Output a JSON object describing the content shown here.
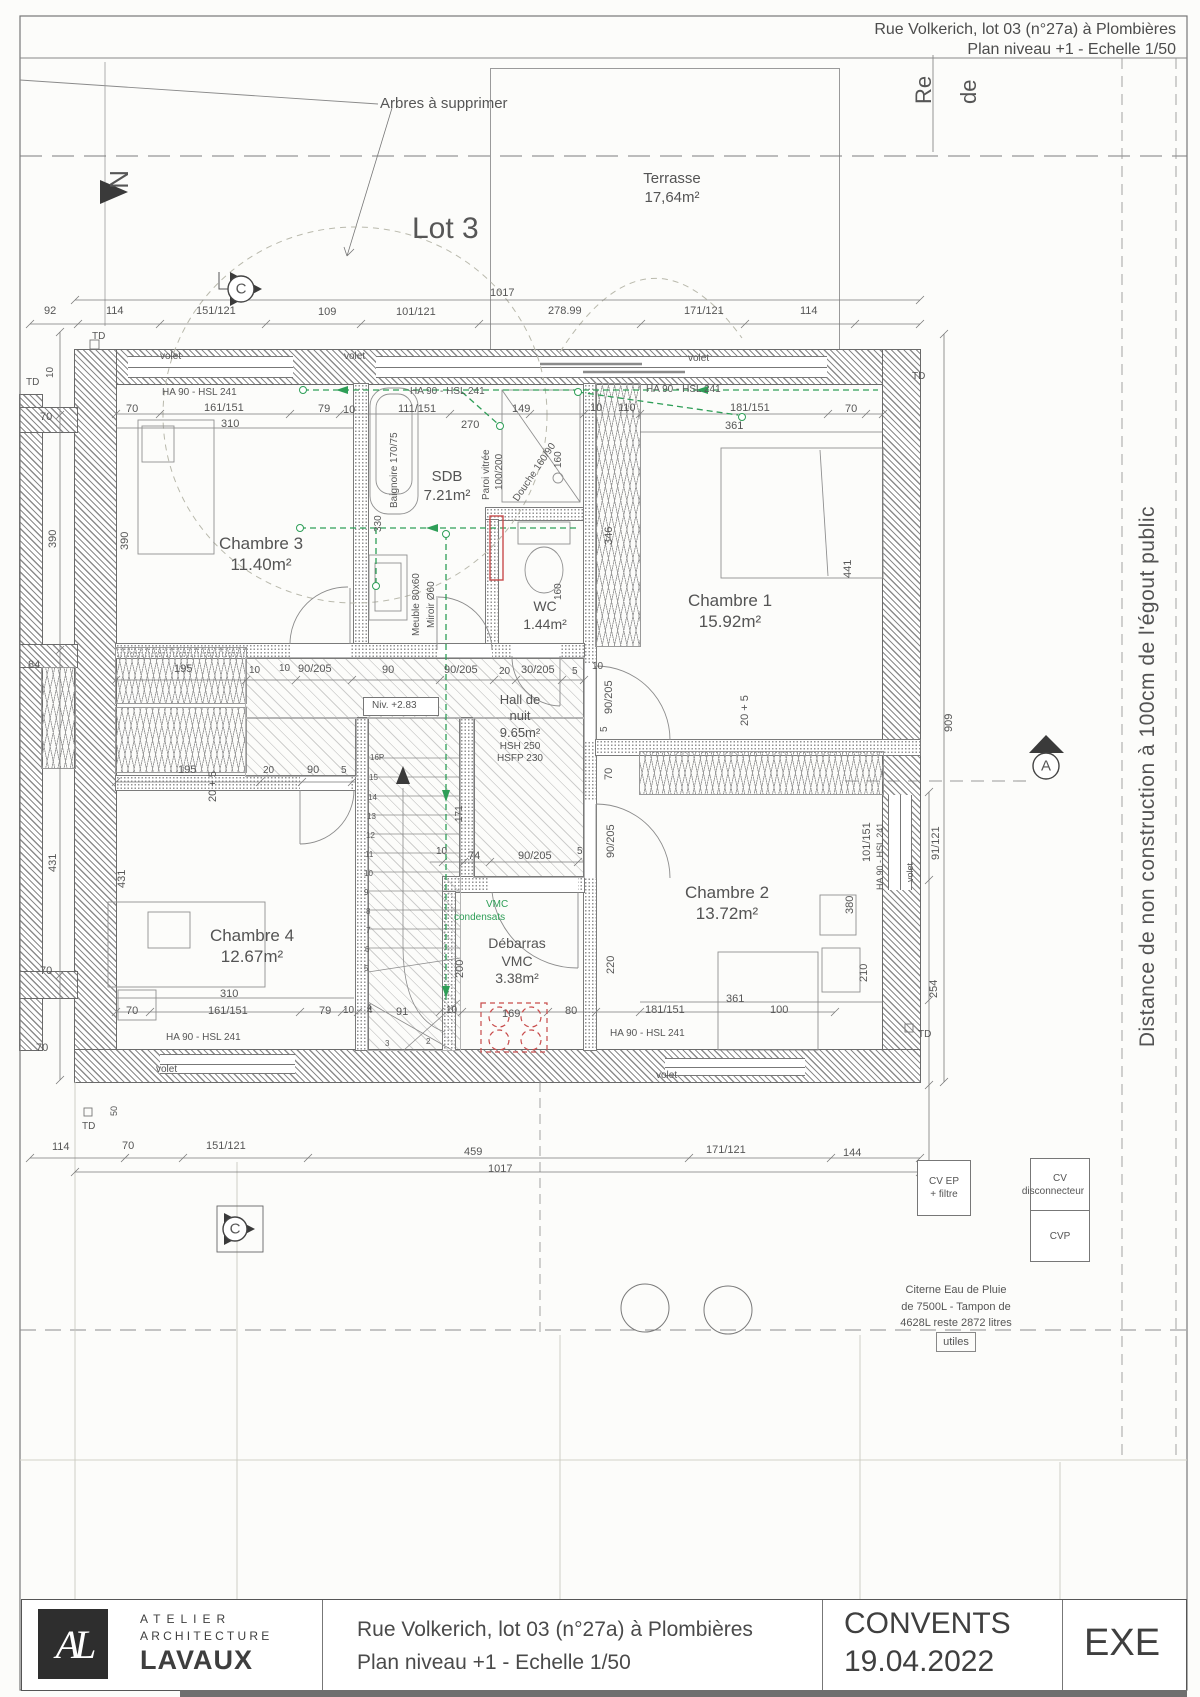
{
  "header": {
    "line1": "Rue Volkerich, lot 03 (n°27a) à Plombières",
    "line2": "Plan niveau +1 - Echelle 1/50"
  },
  "easement_note": "Distance de non construction à 100cm de l'égout public",
  "utilities": {
    "cv_ep_l1": "CV EP",
    "cv_ep_l2": "+ filtre",
    "cv_disc_l1": "CV",
    "cv_disc_l2": "disconnecteur",
    "cvp": "CVP",
    "cistern_l1": "Citerne Eau de Pluie",
    "cistern_l2": "de 7500L - Tampon de",
    "cistern_l3": "4628L reste 2872 litres",
    "cistern_l4": "utiles"
  },
  "title_block": {
    "logo": "AL",
    "company_l1": "ATELIER",
    "company_l2": "ARCHITECTURE",
    "company_l3": "LAVAUX",
    "project_l1": "Rue Volkerich, lot 03 (n°27a) à Plombières",
    "project_l2": "Plan niveau +1 - Echelle 1/50",
    "client": "CONVENTS",
    "date": "19.04.2022",
    "status": "EXE"
  },
  "plan": {
    "rooms": [
      {
        "id": "terrasse",
        "x": 672,
        "y": 170,
        "fs": 15,
        "lines": [
          "Terrasse",
          "17,64m²"
        ],
        "subs": []
      },
      {
        "id": "chambre-3",
        "x": 261,
        "y": 533,
        "fs": 17,
        "lines": [
          "Chambre 3",
          "11.40m²"
        ],
        "subs": []
      },
      {
        "id": "sdb",
        "x": 447,
        "y": 468,
        "fs": 15,
        "lines": [
          "SDB",
          "7.21m²"
        ],
        "subs": []
      },
      {
        "id": "wc",
        "x": 545,
        "y": 598,
        "fs": 14,
        "lines": [
          "WC",
          "1.44m²"
        ],
        "subs": []
      },
      {
        "id": "chambre-1",
        "x": 730,
        "y": 590,
        "fs": 17,
        "lines": [
          "Chambre 1",
          "15.92m²"
        ],
        "subs": []
      },
      {
        "id": "hall-de-nuit",
        "x": 520,
        "y": 692,
        "fs": 13,
        "lines": [
          "Hall de",
          "nuit",
          "9.65m²"
        ],
        "subs": [
          "HSH 250",
          "HSFP 230"
        ]
      },
      {
        "id": "chambre-4",
        "x": 252,
        "y": 925,
        "fs": 17,
        "lines": [
          "Chambre 4",
          "12.67m²"
        ],
        "subs": []
      },
      {
        "id": "debarras-vmc",
        "x": 517,
        "y": 935,
        "fs": 14,
        "lines": [
          "Débarras",
          "VMC",
          "3.38m²"
        ],
        "subs": []
      },
      {
        "id": "chambre-2",
        "x": 727,
        "y": 882,
        "fs": 17,
        "lines": [
          "Chambre 2",
          "13.72m²"
        ],
        "subs": []
      }
    ],
    "annotations": [
      {
        "t": "Arbres à supprimer",
        "x": 380,
        "y": 96,
        "s": 15,
        "n": "trees-note"
      },
      {
        "t": "Lot 3",
        "x": 412,
        "y": 214,
        "s": 30,
        "n": "lot-label"
      },
      {
        "t": "N",
        "x": 132,
        "y": 170,
        "r": 90,
        "s": 26,
        "n": "north-letter"
      },
      {
        "t": "Re",
        "x": 913,
        "y": 104,
        "r": -90,
        "s": 22,
        "n": "edge-label"
      },
      {
        "t": "de",
        "x": 958,
        "y": 104,
        "r": -90,
        "s": 22,
        "n": "edge-label"
      },
      {
        "t": "92",
        "x": 44,
        "y": 306
      },
      {
        "t": "114",
        "x": 106,
        "y": 306
      },
      {
        "t": "151/121",
        "x": 196,
        "y": 306
      },
      {
        "t": "109",
        "x": 318,
        "y": 307
      },
      {
        "t": "101/121",
        "x": 396,
        "y": 307
      },
      {
        "t": "278.99",
        "x": 548,
        "y": 306
      },
      {
        "t": "171/121",
        "x": 684,
        "y": 306
      },
      {
        "t": "114",
        "x": 800,
        "y": 306
      },
      {
        "t": "1017",
        "x": 490,
        "y": 288
      },
      {
        "t": "TD",
        "x": 92,
        "y": 332,
        "s": 10
      },
      {
        "t": "TD",
        "x": 26,
        "y": 378,
        "s": 10
      },
      {
        "t": "10",
        "x": 46,
        "y": 378,
        "r": -90,
        "s": 10
      },
      {
        "t": "volet",
        "x": 160,
        "y": 352,
        "s": 10
      },
      {
        "t": "volet",
        "x": 344,
        "y": 352,
        "s": 10
      },
      {
        "t": "volet",
        "x": 688,
        "y": 354,
        "s": 10
      },
      {
        "t": "TD",
        "x": 912,
        "y": 372,
        "s": 10
      },
      {
        "t": "HA 90 - HSL 241",
        "x": 162,
        "y": 388,
        "s": 10
      },
      {
        "t": "HA 90 - HSL 241",
        "x": 410,
        "y": 387,
        "s": 10
      },
      {
        "t": "HA 90 - HSL 241",
        "x": 646,
        "y": 385,
        "s": 10
      },
      {
        "t": "70",
        "x": 126,
        "y": 404
      },
      {
        "t": "161/151",
        "x": 204,
        "y": 403
      },
      {
        "t": "310",
        "x": 221,
        "y": 419
      },
      {
        "t": "79",
        "x": 318,
        "y": 404
      },
      {
        "t": "10",
        "x": 343,
        "y": 405
      },
      {
        "t": "111/151",
        "x": 398,
        "y": 404
      },
      {
        "t": "270",
        "x": 461,
        "y": 420
      },
      {
        "t": "149",
        "x": 512,
        "y": 404
      },
      {
        "t": "10",
        "x": 590,
        "y": 403
      },
      {
        "t": "110",
        "x": 618,
        "y": 403
      },
      {
        "t": "181/151",
        "x": 730,
        "y": 403
      },
      {
        "t": "70",
        "x": 845,
        "y": 404
      },
      {
        "t": "361",
        "x": 725,
        "y": 421
      },
      {
        "t": "390",
        "x": 48,
        "y": 548,
        "r": -90
      },
      {
        "t": "390",
        "x": 120,
        "y": 550,
        "r": -90
      },
      {
        "t": "Baignoire 170/75",
        "x": 390,
        "y": 508,
        "r": -90,
        "s": 10
      },
      {
        "t": "330",
        "x": 374,
        "y": 532,
        "r": -90,
        "s": 10
      },
      {
        "t": "Paroi vitrée",
        "x": 482,
        "y": 500,
        "r": -90,
        "s": 10
      },
      {
        "t": "100/200",
        "x": 495,
        "y": 490,
        "r": -90,
        "s": 10
      },
      {
        "t": "Douche 160/90",
        "x": 512,
        "y": 498,
        "r": -56,
        "s": 10
      },
      {
        "t": "160",
        "x": 554,
        "y": 468,
        "r": -90,
        "s": 10
      },
      {
        "t": "160",
        "x": 554,
        "y": 600,
        "r": -90,
        "s": 10
      },
      {
        "t": "346",
        "x": 604,
        "y": 545,
        "r": -90
      },
      {
        "t": "441",
        "x": 843,
        "y": 578,
        "r": -90
      },
      {
        "t": "Meuble 80x60",
        "x": 412,
        "y": 636,
        "r": -90,
        "s": 10
      },
      {
        "t": "Miroir Ø60",
        "x": 427,
        "y": 628,
        "r": -90,
        "s": 10
      },
      {
        "t": "195",
        "x": 174,
        "y": 664
      },
      {
        "t": "10",
        "x": 249,
        "y": 666,
        "s": 10
      },
      {
        "t": "10",
        "x": 279,
        "y": 664,
        "s": 10
      },
      {
        "t": "90/205",
        "x": 298,
        "y": 664
      },
      {
        "t": "90",
        "x": 382,
        "y": 665
      },
      {
        "t": "90/205",
        "x": 444,
        "y": 665
      },
      {
        "t": "20",
        "x": 499,
        "y": 667,
        "s": 10
      },
      {
        "t": "30/205",
        "x": 521,
        "y": 665
      },
      {
        "t": "5",
        "x": 572,
        "y": 667,
        "s": 10
      },
      {
        "t": "10",
        "x": 592,
        "y": 662,
        "s": 10
      },
      {
        "t": "Niv. +2.83",
        "x": 372,
        "y": 701,
        "s": 10,
        "n": "level-note"
      },
      {
        "t": "90/205",
        "x": 604,
        "y": 714,
        "r": -90
      },
      {
        "t": "5",
        "x": 600,
        "y": 732,
        "r": -90,
        "s": 10
      },
      {
        "t": "70",
        "x": 604,
        "y": 780,
        "r": -90
      },
      {
        "t": "20 + 5",
        "x": 740,
        "y": 726,
        "r": -90
      },
      {
        "t": "20 + 5",
        "x": 208,
        "y": 802,
        "r": -90
      },
      {
        "t": "195",
        "x": 178,
        "y": 765
      },
      {
        "t": "20",
        "x": 263,
        "y": 766,
        "s": 10
      },
      {
        "t": "90",
        "x": 307,
        "y": 765
      },
      {
        "t": "5",
        "x": 341,
        "y": 766,
        "s": 10
      },
      {
        "t": "84",
        "x": 28,
        "y": 660
      },
      {
        "t": "70",
        "x": 40,
        "y": 412
      },
      {
        "t": "70",
        "x": 40,
        "y": 966
      },
      {
        "t": "431",
        "x": 48,
        "y": 872,
        "r": -90
      },
      {
        "t": "431",
        "x": 117,
        "y": 888,
        "r": -90
      },
      {
        "t": "16P",
        "x": 370,
        "y": 754,
        "s": 8,
        "n": "stair-step-number"
      },
      {
        "t": "15",
        "x": 369,
        "y": 774,
        "s": 8,
        "n": "stair-step-number"
      },
      {
        "t": "14",
        "x": 368,
        "y": 794,
        "s": 8,
        "n": "stair-step-number"
      },
      {
        "t": "13",
        "x": 367,
        "y": 813,
        "s": 8,
        "n": "stair-step-number"
      },
      {
        "t": "12",
        "x": 366,
        "y": 832,
        "s": 8,
        "n": "stair-step-number"
      },
      {
        "t": "11",
        "x": 365,
        "y": 851,
        "s": 8,
        "n": "stair-step-number"
      },
      {
        "t": "10",
        "x": 364,
        "y": 870,
        "s": 8,
        "n": "stair-step-number"
      },
      {
        "t": "9",
        "x": 364,
        "y": 889,
        "s": 8,
        "n": "stair-step-number"
      },
      {
        "t": "8",
        "x": 366,
        "y": 908,
        "s": 8,
        "n": "stair-step-number"
      },
      {
        "t": "7",
        "x": 366,
        "y": 927,
        "s": 8,
        "n": "stair-step-number"
      },
      {
        "t": "6",
        "x": 365,
        "y": 946,
        "s": 8,
        "n": "stair-step-number"
      },
      {
        "t": "5",
        "x": 364,
        "y": 965,
        "s": 8,
        "n": "stair-step-number"
      },
      {
        "t": "4",
        "x": 367,
        "y": 1004,
        "s": 8,
        "n": "stair-step-number"
      },
      {
        "t": "3",
        "x": 385,
        "y": 1040,
        "s": 8,
        "n": "stair-step-number"
      },
      {
        "t": "2",
        "x": 426,
        "y": 1038,
        "s": 8,
        "n": "stair-step-number"
      },
      {
        "t": "VMC",
        "x": 486,
        "y": 900,
        "s": 10,
        "c": "green",
        "n": "vmc-note"
      },
      {
        "t": "condensats",
        "x": 454,
        "y": 913,
        "s": 10,
        "c": "green",
        "n": "vmc-note"
      },
      {
        "t": "171",
        "x": 455,
        "y": 822,
        "r": -90,
        "s": 10
      },
      {
        "t": "10",
        "x": 436,
        "y": 847,
        "s": 10
      },
      {
        "t": "74",
        "x": 468,
        "y": 851
      },
      {
        "t": "90/205",
        "x": 518,
        "y": 851
      },
      {
        "t": "5",
        "x": 577,
        "y": 847,
        "s": 10
      },
      {
        "t": "90/205",
        "x": 606,
        "y": 858,
        "r": -90
      },
      {
        "t": "220",
        "x": 606,
        "y": 974,
        "r": -90
      },
      {
        "t": "200",
        "x": 455,
        "y": 978,
        "r": -90
      },
      {
        "t": "101/151",
        "x": 862,
        "y": 862,
        "r": -90
      },
      {
        "t": "380",
        "x": 845,
        "y": 914,
        "r": -90
      },
      {
        "t": "210",
        "x": 859,
        "y": 982,
        "r": -90
      },
      {
        "t": "361",
        "x": 726,
        "y": 994
      },
      {
        "t": "HA 90 - HSL 241",
        "x": 876,
        "y": 890,
        "r": -90,
        "s": 9
      },
      {
        "t": "volet",
        "x": 906,
        "y": 882,
        "r": -90,
        "s": 9
      },
      {
        "t": "91/121",
        "x": 931,
        "y": 860,
        "r": -90
      },
      {
        "t": "254",
        "x": 929,
        "y": 998,
        "r": -90
      },
      {
        "t": "909",
        "x": 944,
        "y": 732,
        "r": -90
      },
      {
        "t": "TD",
        "x": 918,
        "y": 1030,
        "s": 10
      },
      {
        "t": "310",
        "x": 220,
        "y": 989
      },
      {
        "t": "70",
        "x": 126,
        "y": 1006
      },
      {
        "t": "161/151",
        "x": 208,
        "y": 1006
      },
      {
        "t": "79",
        "x": 319,
        "y": 1006
      },
      {
        "t": "10",
        "x": 343,
        "y": 1006,
        "s": 10
      },
      {
        "t": "4",
        "x": 367,
        "y": 1006,
        "s": 10
      },
      {
        "t": "91",
        "x": 396,
        "y": 1007
      },
      {
        "t": "10",
        "x": 446,
        "y": 1006,
        "s": 10
      },
      {
        "t": "169",
        "x": 502,
        "y": 1009
      },
      {
        "t": "80",
        "x": 565,
        "y": 1006
      },
      {
        "t": "181/151",
        "x": 645,
        "y": 1005
      },
      {
        "t": "100",
        "x": 770,
        "y": 1005
      },
      {
        "t": "HA 90 - HSL 241",
        "x": 166,
        "y": 1033,
        "s": 10
      },
      {
        "t": "HA 90 - HSL 241",
        "x": 610,
        "y": 1029,
        "s": 10
      },
      {
        "t": "volet",
        "x": 156,
        "y": 1065,
        "s": 10
      },
      {
        "t": "volet",
        "x": 656,
        "y": 1071,
        "s": 10
      },
      {
        "t": "70",
        "x": 36,
        "y": 1043
      },
      {
        "t": "TD",
        "x": 82,
        "y": 1122,
        "s": 10
      },
      {
        "t": "50",
        "x": 110,
        "y": 1116,
        "r": -90,
        "s": 9
      },
      {
        "t": "114",
        "x": 52,
        "y": 1142
      },
      {
        "t": "70",
        "x": 122,
        "y": 1141
      },
      {
        "t": "151/121",
        "x": 206,
        "y": 1141
      },
      {
        "t": "459",
        "x": 464,
        "y": 1147
      },
      {
        "t": "171/121",
        "x": 706,
        "y": 1145
      },
      {
        "t": "144",
        "x": 843,
        "y": 1148
      },
      {
        "t": "1017",
        "x": 488,
        "y": 1164
      },
      {
        "t": "C",
        "x": 241,
        "y": 289,
        "s": 15,
        "ctr": 1,
        "n": "section-marker-letter"
      },
      {
        "t": "C",
        "x": 235,
        "y": 1229,
        "s": 15,
        "ctr": 1,
        "n": "section-marker-letter"
      },
      {
        "t": "A",
        "x": 1046,
        "y": 766,
        "s": 15,
        "ctr": 1,
        "n": "section-marker-letter"
      }
    ]
  }
}
